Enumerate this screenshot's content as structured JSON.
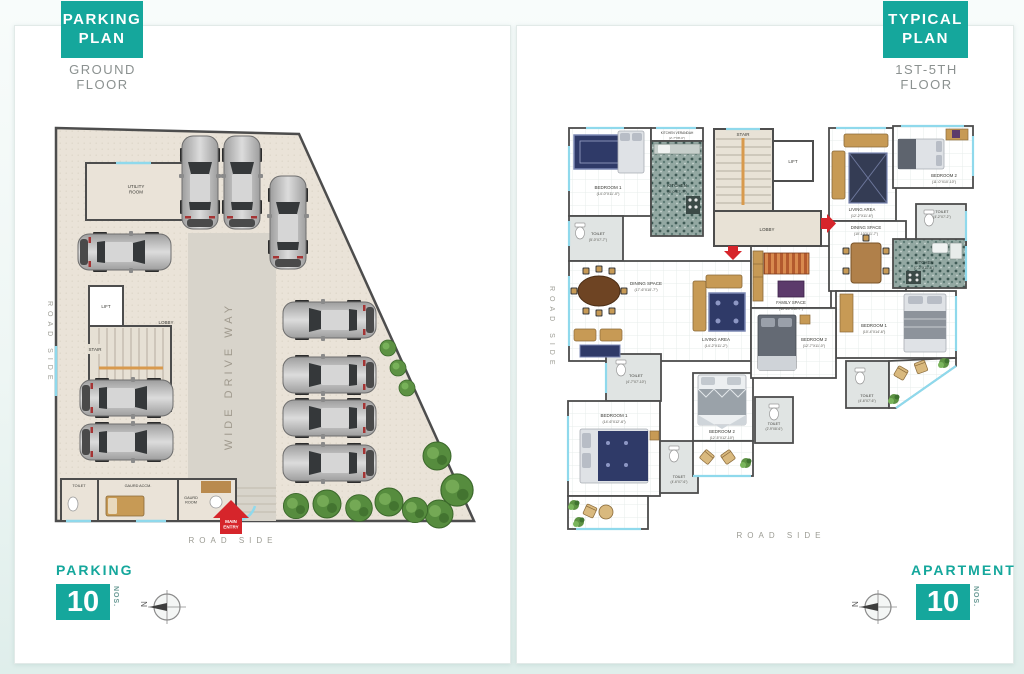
{
  "theme": {
    "teal": "#15A79C",
    "red": "#D6252B",
    "wall": "#4D4D4D",
    "floor_beige": "#EAE3D8",
    "drive_gray": "#D8D4CB",
    "window_cyan": "#8FD9EC",
    "green": "#568C3E",
    "wood": "#C79A55",
    "text_gray": "#9B9B93"
  },
  "parking_panel": {
    "tag_line1": "PARKING",
    "tag_line2": "PLAN",
    "subtitle": "GROUND FLOOR",
    "footer": {
      "label": "PARKING",
      "count": "10",
      "unit": "NOS."
    },
    "compass_letter": "N",
    "labels": {
      "utility": [
        "UTILITY",
        "ROOM"
      ],
      "lift": "LIFT",
      "stair": "STAIR",
      "lobby": "LOBBY",
      "drive_way": "WIDE DRIVE WAY",
      "toilet": "TOILET",
      "guard_accm": "GAURD ACCM.",
      "guard_room": [
        "GAURD",
        "ROOM"
      ],
      "main_entry": [
        "MAIN",
        "ENTRY"
      ],
      "road_side_left": "ROAD SIDE",
      "road_side_bottom": "ROAD SIDE"
    }
  },
  "apartment_panel": {
    "tag_line1": "TYPICAL",
    "tag_line2": "PLAN",
    "subtitle": "1ST-5TH FLOOR",
    "footer": {
      "label": "APARTMENT",
      "count": "10",
      "unit": "NOS."
    },
    "compass_letter": "N",
    "core": {
      "stair": "STAIR",
      "lift": "LIFT",
      "lobby": "LOBBY"
    },
    "road_side_left": "ROAD SIDE",
    "road_side_bottom": "ROAD SIDE",
    "unit_a": {
      "bedroom1_top": {
        "name": "BEDROOM 1",
        "dims": "(14'-0\"X11'-0\")"
      },
      "kitchen_verandah": {
        "name": "KITCHEN VERANDAH",
        "dims": "(2'-7\"X8'-0\")"
      },
      "kitchen": {
        "name": "KITCHEN",
        "dims": "(8'-0\"X7'-7\")"
      },
      "toilet_top": {
        "name": "TOILET",
        "dims": "(5'-0\"X7'-7\")"
      },
      "dining": {
        "name": "DINING SPACE",
        "dims": "(17'-6\"X10'-7\")"
      },
      "living": {
        "name": "LIVING AREA",
        "dims": "(14'-2\"X11'-2\")"
      },
      "family": {
        "name": "FAMILY SPACE",
        "dims": "(10'-10\"X10'-7\")"
      },
      "toilet_mid": {
        "name": "TOILET",
        "dims": "(4'-7\"X7'-10\")"
      },
      "bedroom1_bottom": {
        "name": "BEDROOM 1",
        "dims": "(14'-6\"X12'-6\")"
      },
      "toilet_bottom": {
        "name": "TOILET",
        "dims": "(4'-6\"X7'-6\")"
      },
      "bedroom2_bottom": {
        "name": "BEDROOM 2",
        "dims": "(12'-5\"X12'-10\")"
      },
      "toilet_small": {
        "name": "TOILET",
        "dims": "(2'-9\"X8'-6\")"
      }
    },
    "unit_b": {
      "living": {
        "name": "LIVING AREA",
        "dims": "(12'-2\"X11'-6\")"
      },
      "bedroom2_top": {
        "name": "BEDROOM 2",
        "dims": "(11'-0\"X10'-10\")"
      },
      "dining": {
        "name": "DINING SPACE",
        "dims": "(10'-10\"X11'-7\")"
      },
      "toilet_top": {
        "name": "TOILET",
        "dims": "(4'-2\"X7'-2\")"
      },
      "kitchen": {
        "name": "KITCHEN",
        "dims": "(7'-2\"X11'-6\")"
      },
      "bedroom1": {
        "name": "BEDROOM 1",
        "dims": "(10'-4\"X14'-6\")"
      },
      "bedroom2_mid": {
        "name": "BEDROOM 2",
        "dims": "(12'-7\"X11'-0\")"
      },
      "toilet_mid": {
        "name": "TOILET",
        "dims": "(4'-6\"X7'-6\")"
      }
    }
  }
}
